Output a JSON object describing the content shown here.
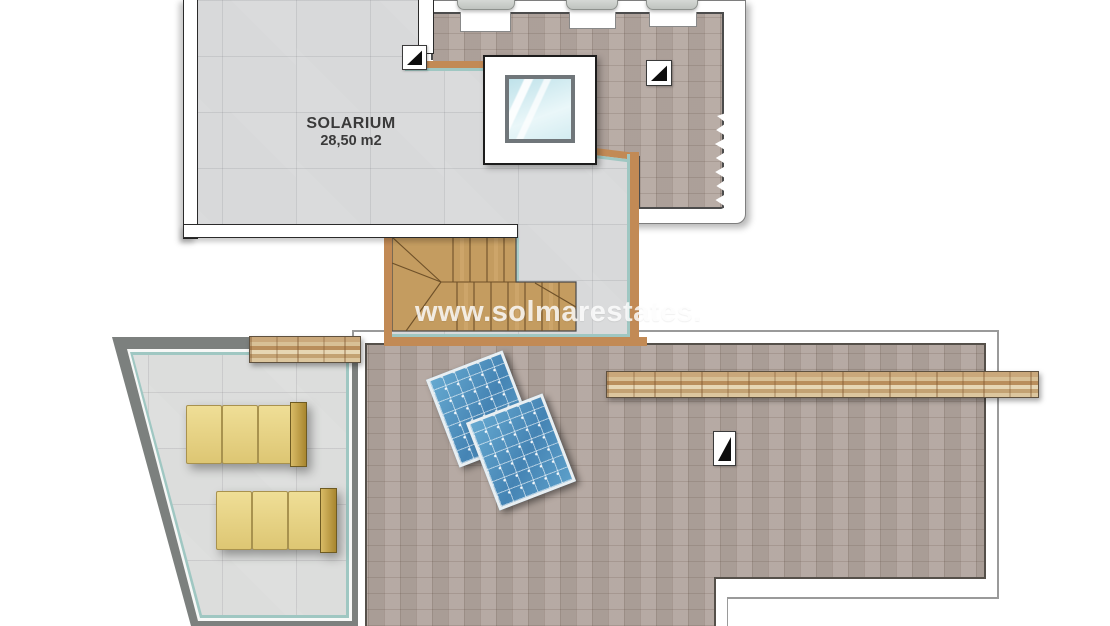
{
  "plan": {
    "room": {
      "label": "SOLARIUM",
      "area": "28,50 m2"
    },
    "watermark": "www.solmarestates.",
    "features": {
      "skylight_count": 1,
      "solar_panel_count": 2,
      "sun_lounger_count": 2,
      "staircase_count": 1,
      "slope_marker_icons": [
        "slope-marker-icon",
        "slope-marker-icon",
        "drain-marker-icon"
      ]
    },
    "colors": {
      "gray_tile": "#d8d9da",
      "brown_tile": "#b2a59e",
      "wood": "#c49c60",
      "tan_border": "#c28a55",
      "teal_border": "#9fc7c2",
      "dark_band": "#7c807e",
      "lounger_yellow": "#e9d686",
      "panel_blue": "#4d8fbd",
      "stone": "#cdae7f",
      "glass_blue": "#cfe9ee"
    }
  }
}
